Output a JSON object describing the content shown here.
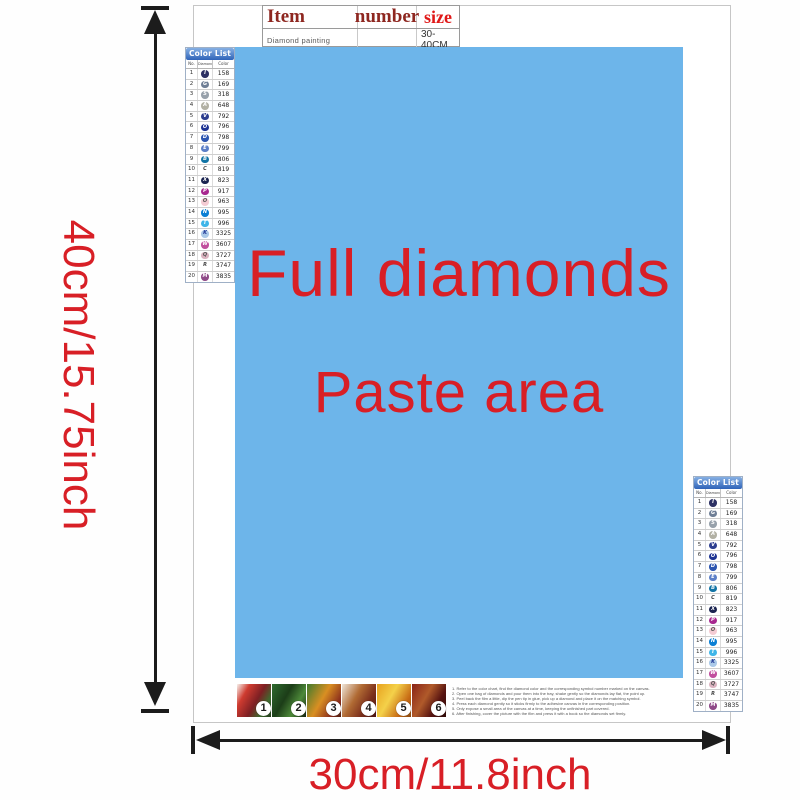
{
  "page": {
    "background": "#ffffff"
  },
  "item_table": {
    "headers": {
      "item": "Item",
      "number": "number",
      "size": "size"
    },
    "row": {
      "item": "Diamond painting",
      "number": "",
      "size": "30-40CM"
    }
  },
  "paste_area": {
    "line1": "Full diamonds",
    "line2": "Paste area",
    "bg_color": "#6db5ea",
    "text_color": "#e0201c"
  },
  "dimensions": {
    "height_label": "40cm/15.75inch",
    "width_label": "30cm/11.8inch",
    "label_color": "#d81f26",
    "arrow_color": "#1c1c1c"
  },
  "color_list": {
    "title": "Color List",
    "columns": {
      "no": "No.",
      "diamond": "Diamond",
      "color": "Color"
    },
    "rows": [
      {
        "no": "1",
        "sym": "I",
        "code": "158",
        "bg": "#2c3063",
        "fg": "#ffffff"
      },
      {
        "no": "2",
        "sym": "G",
        "code": "169",
        "bg": "#6f7f96",
        "fg": "#ffffff"
      },
      {
        "no": "3",
        "sym": "S",
        "code": "318",
        "bg": "#97a1ab",
        "fg": "#ffffff"
      },
      {
        "no": "4",
        "sym": "A",
        "code": "648",
        "bg": "#b2b1a4",
        "fg": "#ffffff"
      },
      {
        "no": "5",
        "sym": "V",
        "code": "792",
        "bg": "#2d3e8f",
        "fg": "#ffffff"
      },
      {
        "no": "6",
        "sym": "O",
        "code": "796",
        "bg": "#1d3393",
        "fg": "#ffffff"
      },
      {
        "no": "7",
        "sym": "D",
        "code": "798",
        "bg": "#2c55b0",
        "fg": "#ffffff"
      },
      {
        "no": "8",
        "sym": "E",
        "code": "799",
        "bg": "#5c7fc7",
        "fg": "#ffffff"
      },
      {
        "no": "9",
        "sym": "B",
        "code": "806",
        "bg": "#1274a5",
        "fg": "#ffffff"
      },
      {
        "no": "10",
        "sym": "C",
        "code": "819",
        "bg": "transparent",
        "fg": "#444444"
      },
      {
        "no": "11",
        "sym": "X",
        "code": "823",
        "bg": "#1a2350",
        "fg": "#ffffff"
      },
      {
        "no": "12",
        "sym": "P",
        "code": "917",
        "bg": "#a8278f",
        "fg": "#ffffff"
      },
      {
        "no": "13",
        "sym": "O",
        "code": "963",
        "bg": "#f4cbd3",
        "fg": "#555555"
      },
      {
        "no": "14",
        "sym": "N",
        "code": "995",
        "bg": "#0b7fd4",
        "fg": "#ffffff"
      },
      {
        "no": "15",
        "sym": "T",
        "code": "996",
        "bg": "#3fb5e8",
        "fg": "#ffffff"
      },
      {
        "no": "16",
        "sym": "K",
        "code": "3325",
        "bg": "#aac9e8",
        "fg": "#1d3393"
      },
      {
        "no": "17",
        "sym": "W",
        "code": "3607",
        "bg": "#c14f9e",
        "fg": "#ffffff"
      },
      {
        "no": "18",
        "sym": "Q",
        "code": "3727",
        "bg": "#dbb3c0",
        "fg": "#555555"
      },
      {
        "no": "19",
        "sym": "R",
        "code": "3747",
        "bg": "transparent",
        "fg": "#444444"
      },
      {
        "no": "20",
        "sym": "M",
        "code": "3835",
        "bg": "#8f4a88",
        "fg": "#ffffff"
      }
    ]
  },
  "steps": {
    "items": [
      {
        "num": "1",
        "bg": "linear-gradient(120deg,#f6f3ee 0%,#cf3b30 25%,#7d1f23 55%,#3f6b2f 78%,#243f1c 100%)"
      },
      {
        "num": "2",
        "bg": "linear-gradient(120deg,#2f6b2f 0%,#1c3d18 40%,#4e8a3a 70%,#14220f 100%)"
      },
      {
        "num": "3",
        "bg": "linear-gradient(120deg,#3f7a2e 0%,#d98f22 45%,#8a2d1c 80%,#52210f 100%)"
      },
      {
        "num": "4",
        "bg": "linear-gradient(120deg,#efe6da 0%,#b06a33 40%,#7c2f1c 70%,#4a1410 100%)"
      },
      {
        "num": "5",
        "bg": "linear-gradient(120deg,#e7a21f 0%,#f4d14a 40%,#c76a14 75%,#8a4a10 100%)"
      },
      {
        "num": "6",
        "bg": "linear-gradient(120deg,#8a2418 0%,#b05a2a 40%,#571310 70%,#2e0a08 100%)"
      }
    ]
  },
  "instructions": {
    "lines": [
      "1. Refer to the color chart, find the diamond color and the corresponding symbol number marked on the canvas.",
      "2. Open one bag of diamonds and pour them into the tray, shake gently so the diamonds lay flat, the point up.",
      "3. Peel back the film a little, dip the pen tip in glue, pick up a diamond and place it on the matching symbol.",
      "4. Press each diamond gently so it sticks firmly to the adhesive canvas in the corresponding position.",
      "5. Only expose a small area of the canvas at a time, keeping the unfinished part covered.",
      "6. After finishing, cover the picture with the film and press it with a book so the diamonds set firmly."
    ]
  }
}
